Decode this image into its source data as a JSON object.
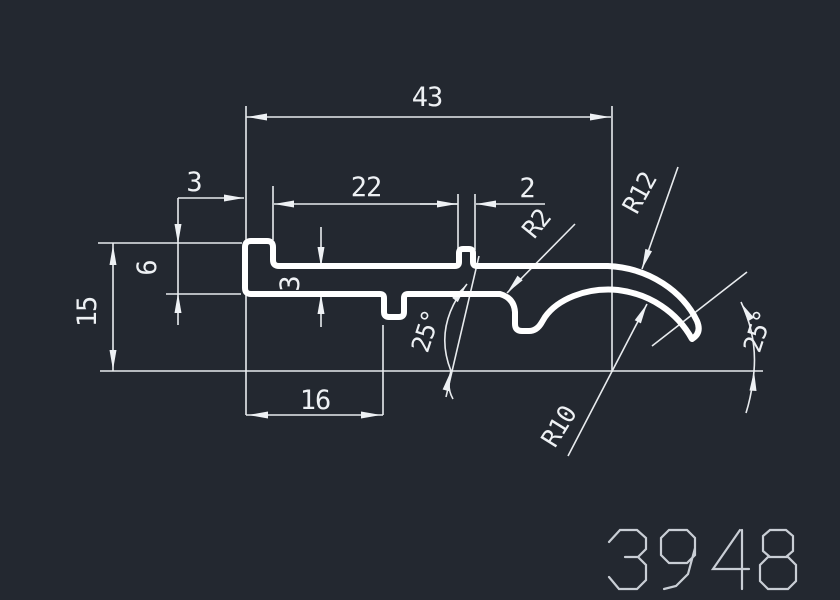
{
  "drawing_number": "3948",
  "colors": {
    "background": "#232830",
    "profile_line": "#ffffff",
    "dimension_line": "#e8ebee",
    "dimension_text": "#eef1f4",
    "drawing_number_text": "#c9ced5"
  },
  "dims": {
    "total_width": "43",
    "lip_width": "3",
    "upper_span": "22",
    "notch_width": "2",
    "flange_height": "6",
    "total_height": "15",
    "wall_thickness": "3",
    "lower_span": "16",
    "fillet_radius": "R2",
    "outer_radius": "R12",
    "inner_radius": "R10",
    "left_angle": "25°",
    "right_angle": "25°"
  }
}
